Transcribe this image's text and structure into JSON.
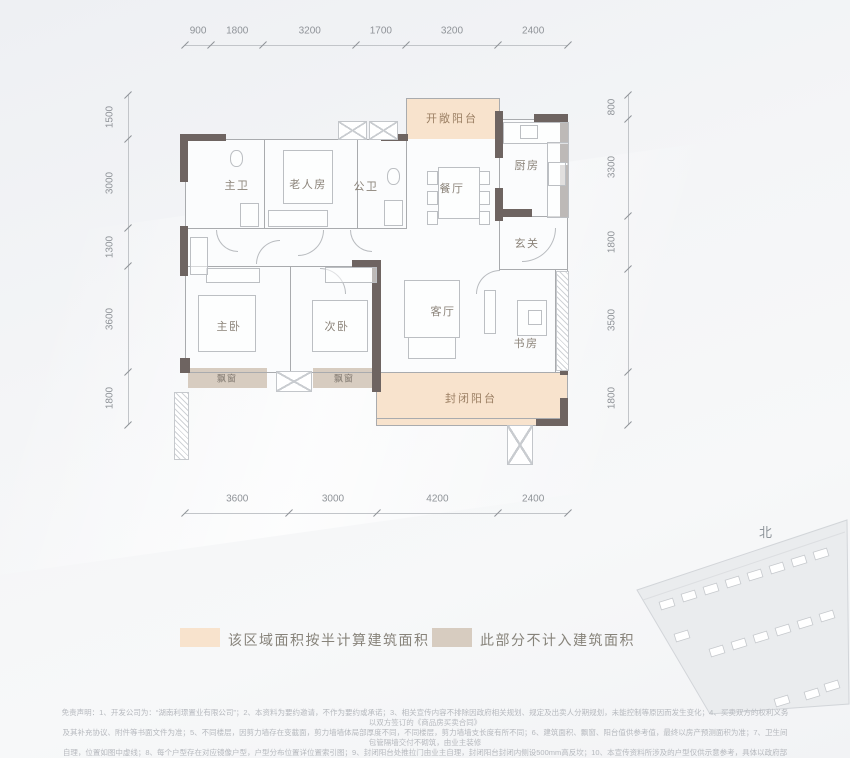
{
  "colors": {
    "half_area_fill": "#f8e3cd",
    "excluded_fill": "#d7ccc0",
    "wall_dark": "#6e6461",
    "accent_balcony_text": "#9b7f63"
  },
  "floorplan": {
    "rooms": [
      {
        "id": "open-balcony",
        "label": "开敞阳台"
      },
      {
        "id": "kitchen",
        "label": "厨房"
      },
      {
        "id": "dining",
        "label": "餐厅"
      },
      {
        "id": "foyer",
        "label": "玄关"
      },
      {
        "id": "master-bath",
        "label": "主卫"
      },
      {
        "id": "elder-room",
        "label": "老人房"
      },
      {
        "id": "public-bath",
        "label": "公卫"
      },
      {
        "id": "master-bedroom",
        "label": "主卧"
      },
      {
        "id": "second-bedroom",
        "label": "次卧"
      },
      {
        "id": "living-room",
        "label": "客厅"
      },
      {
        "id": "study",
        "label": "书房"
      },
      {
        "id": "enclosed-balcony",
        "label": "封闭阳台"
      },
      {
        "id": "bay-window-1",
        "label": "飘窗"
      },
      {
        "id": "bay-window-2",
        "label": "飘窗"
      }
    ],
    "dimensions_mm": {
      "top": [
        900,
        1800,
        3200,
        1700,
        3200,
        2400
      ],
      "bottom": [
        3600,
        3000,
        4200,
        2400
      ],
      "left": [
        1500,
        3000,
        1300,
        3600,
        1800
      ],
      "right": [
        800,
        3300,
        1800,
        3500,
        1800
      ]
    }
  },
  "legend": [
    {
      "id": "half-area",
      "label": "该区域面积按半计算建筑面积",
      "color": "#f8e3cd"
    },
    {
      "id": "excluded-area",
      "label": "此部分不计入建筑面积",
      "color": "#d7ccc0"
    }
  ],
  "compass": {
    "north": "北",
    "south": "南"
  },
  "disclaimer": {
    "lines": [
      "免责声明：1、开发公司为：“湖南利璟置业有限公司”；2、本资料为要约邀请，不作为要约或承诺；3、相关宣传内容不排除因政府相关规划、规定及出卖人分期规划，未能控制等原因而发生变化；4、买卖双方的权利义务以双方签订的《商品房买卖合同》",
      "及其补充协议、附件等书面文件为准；5、不同楼层，因剪力墙存在变截面，剪力墙墙体局部厚度不同，不同楼层，剪力墙墙支长度有所不同；6、建筑面积、飘窗、阳台值供参考值，最终以房产预测面积为准；7、卫生间包管隔墙交付不砌筑，由业主装修",
      "自理，位置如图中虚线；8、每个户型存在对应镜像户型，户型分布位置详位置索引图；9、封闭阳台处推拉门由业主自理，封闭阳台封闭内侧设500mm高反坎；10、本宣传资料所涉及的户型仅供示意参考，具体以政府部门最终审定的图纸和销售合同为准：",
      "11、本资料所发布的内容为2021年11月前的信息，敬请留意最新资料。"
    ]
  }
}
